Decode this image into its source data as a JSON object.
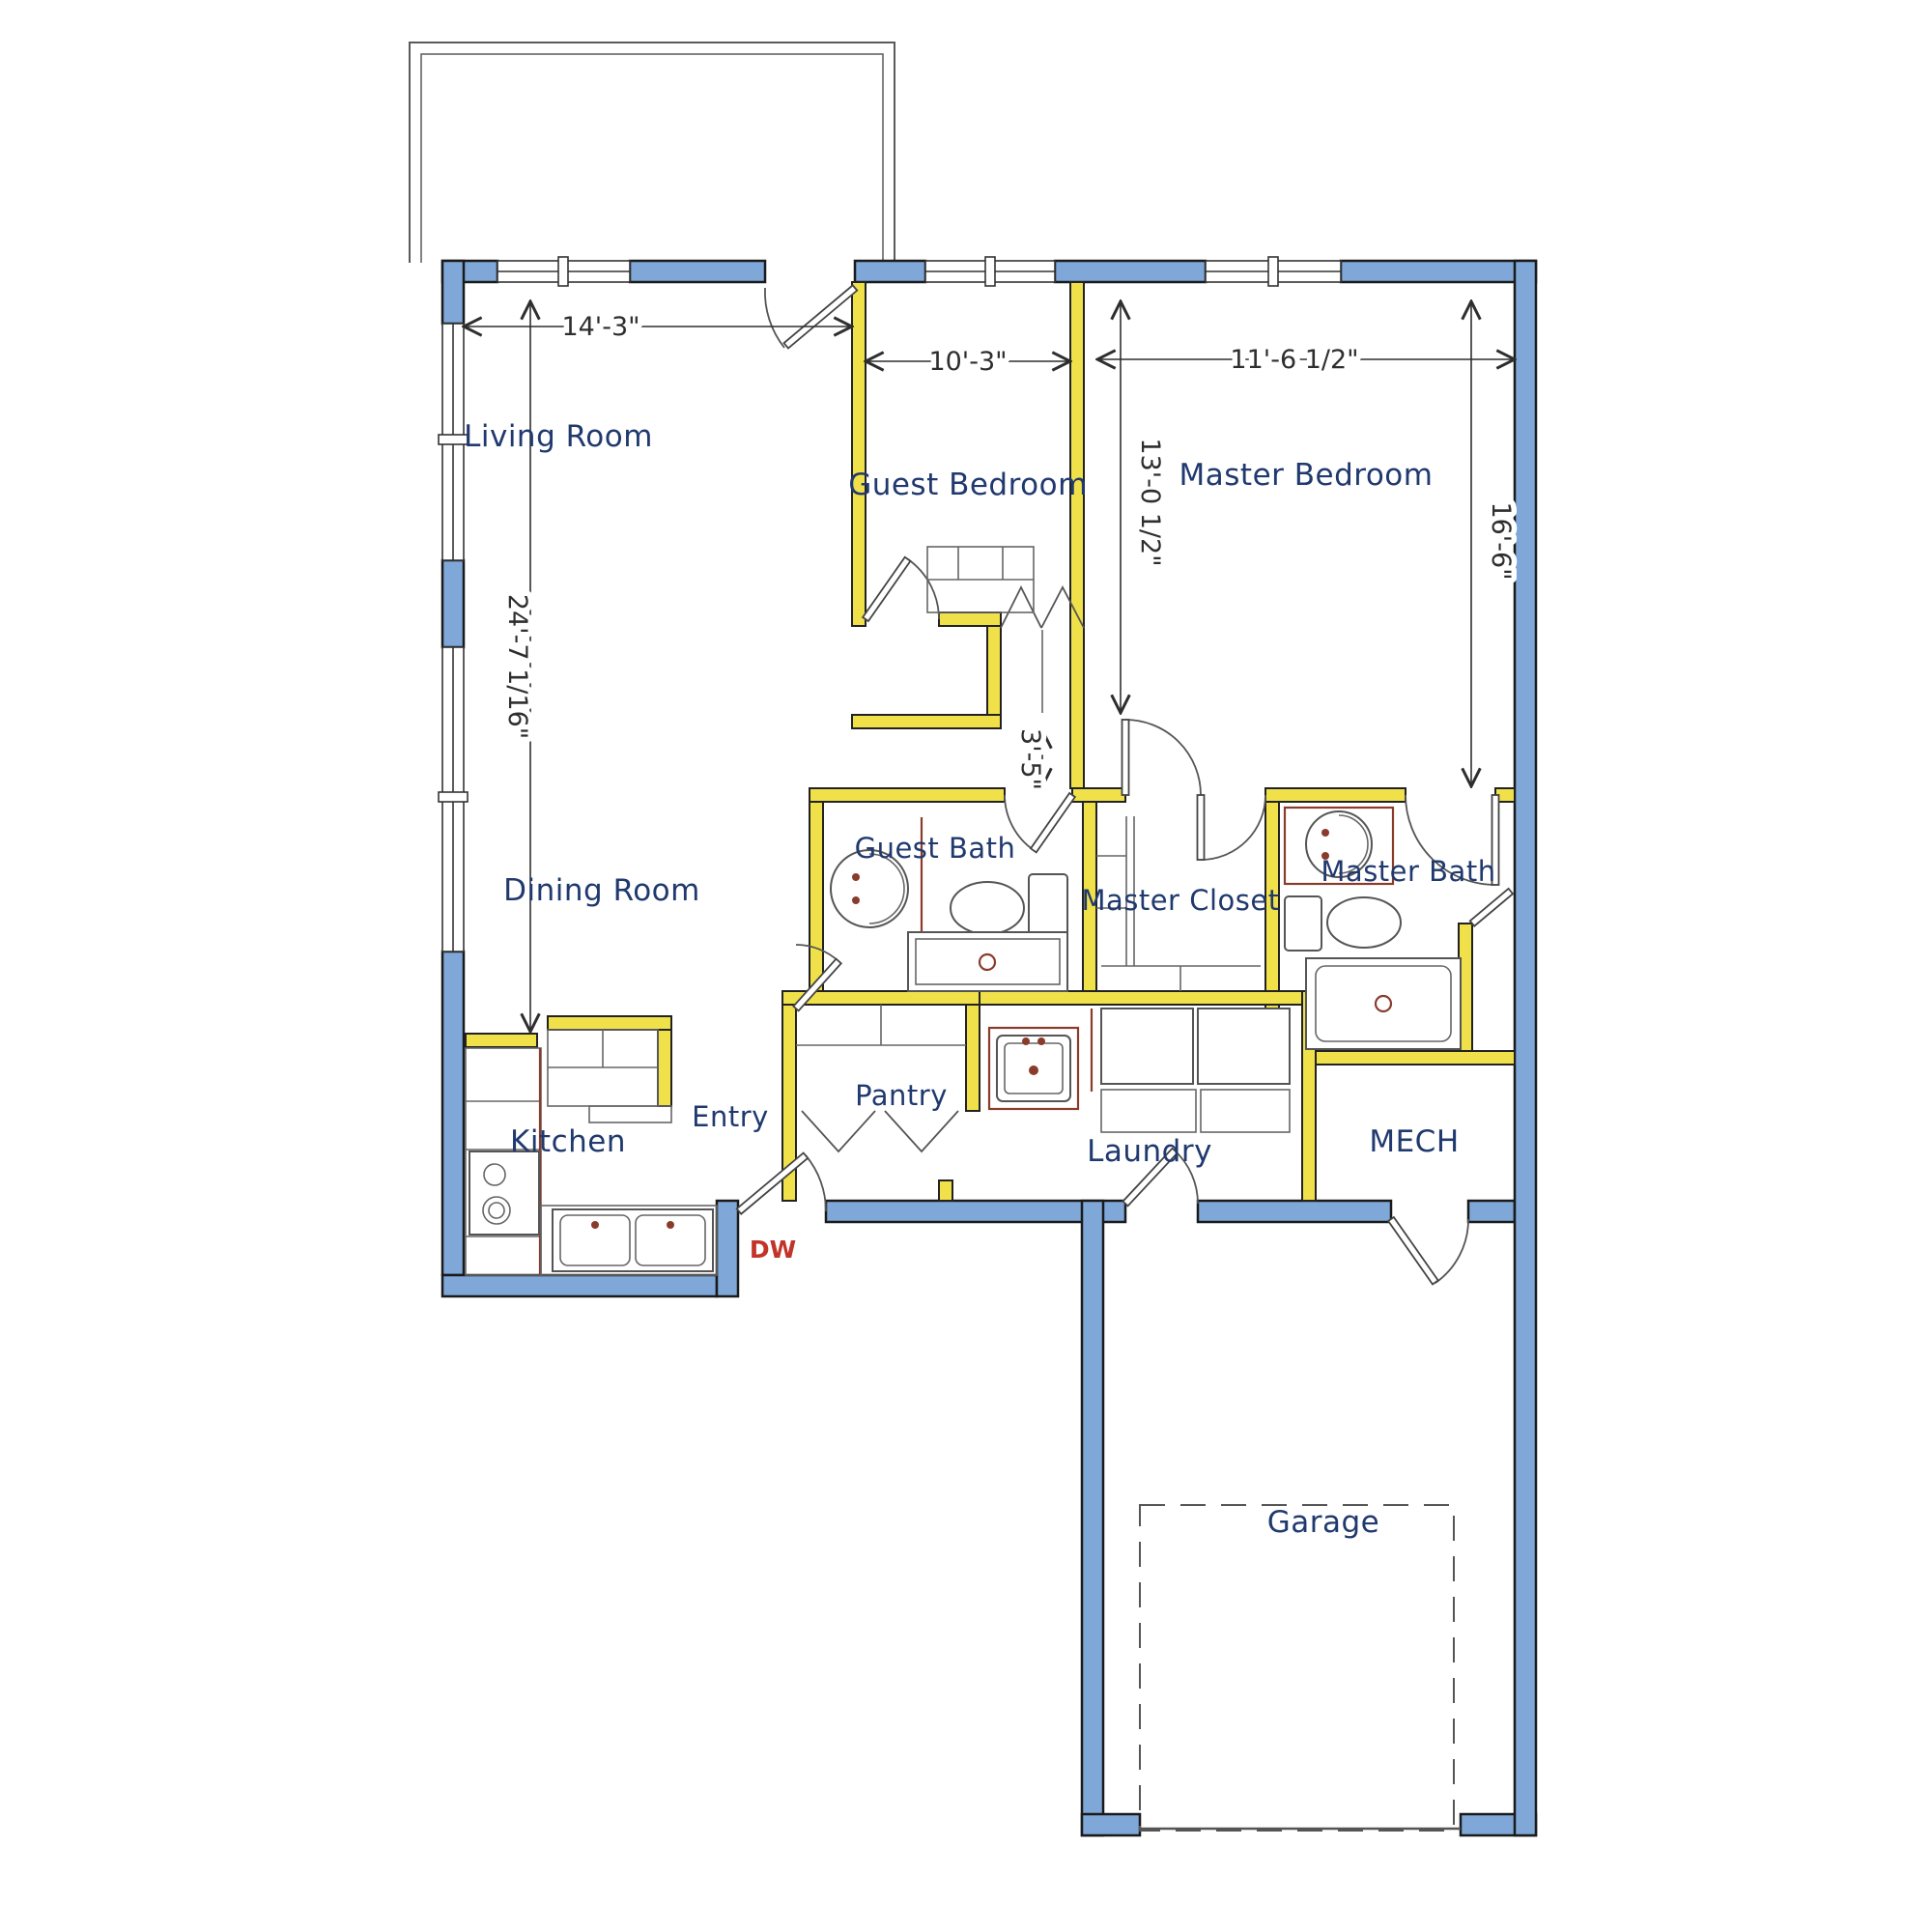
{
  "plan": {
    "title": "Single story house floor plan",
    "rooms": {
      "living_room": "Living Room",
      "guest_bedroom": "Guest Bedroom",
      "master_bedroom": "Master Bedroom",
      "dining_room": "Dining Room",
      "guest_bath": "Guest Bath",
      "master_closet": "Master Closet",
      "master_bath": "Master Bath",
      "kitchen": "Kitchen",
      "entry": "Entry",
      "pantry": "Pantry",
      "laundry": "Laundry",
      "mech": "MECH",
      "garage": "Garage"
    },
    "dimensions": {
      "living_width": "14'-3\"",
      "guest_width": "10'-3\"",
      "master_width": "11'-6 1/2\"",
      "guest_depth": "13'-0 1/2\"",
      "master_depth": "16'-6\"",
      "west_side": "24'-7 1/16\"",
      "hall_width": "3'-5\""
    },
    "appliances": {
      "dishwasher": "DW"
    },
    "colors": {
      "exterior_wall": "#7fa8d9",
      "interior_wall": "#f0e14a",
      "room_label": "#20396e",
      "dimension_text": "#2e2e2e",
      "fixture_accent": "#8a3c2c",
      "dishwasher_label": "#c2342a"
    }
  }
}
